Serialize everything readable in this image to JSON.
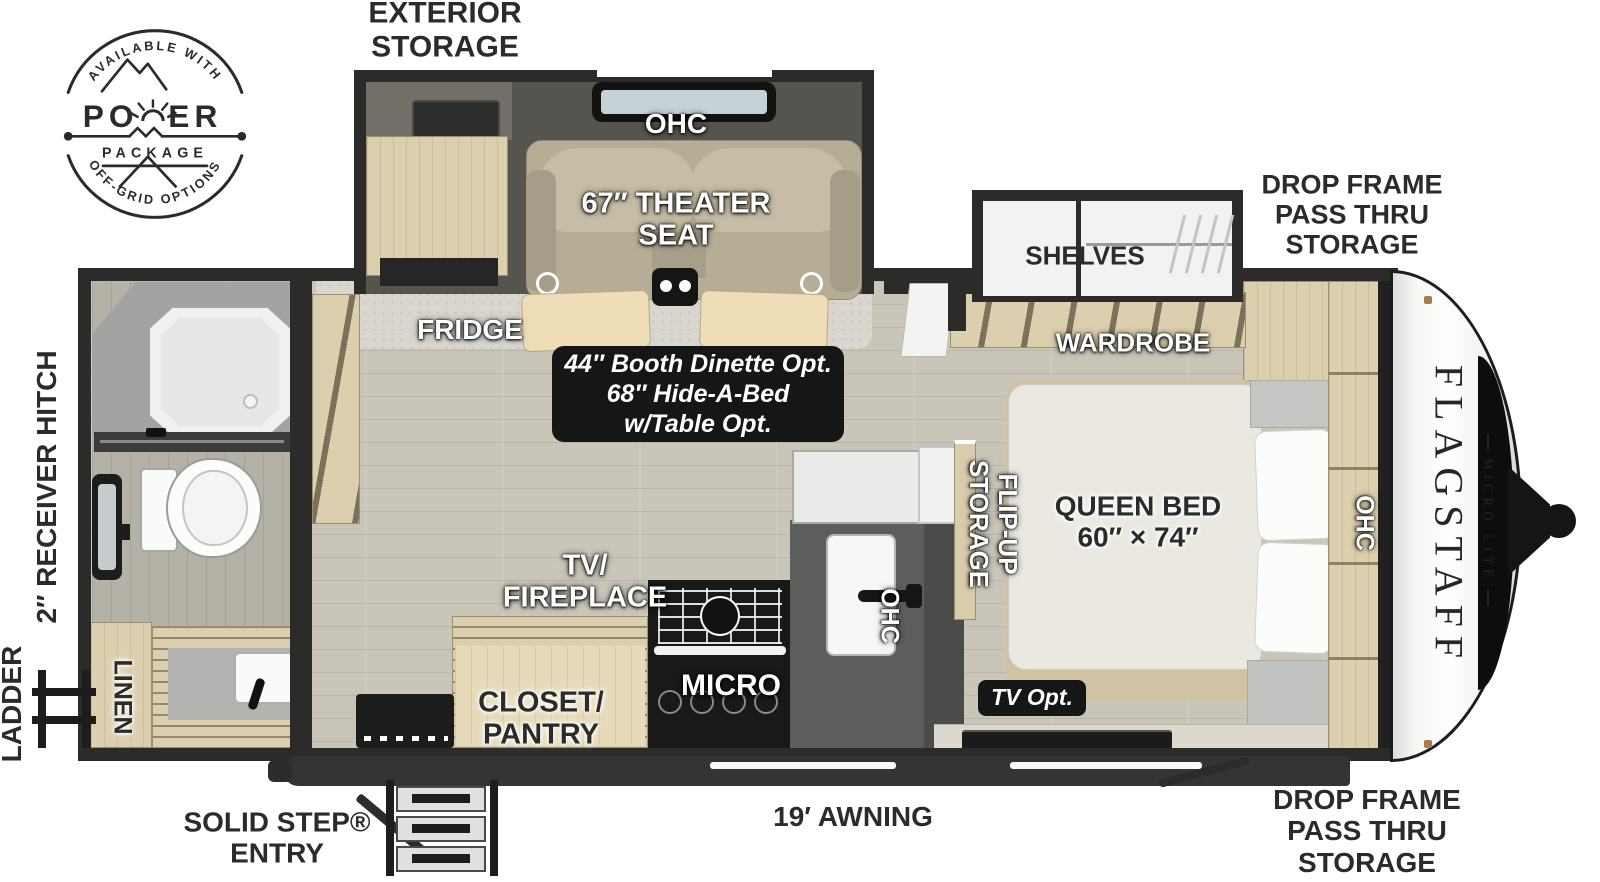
{
  "badge": {
    "arc_top": "AVAILABLE WITH",
    "power_left": "PO",
    "power_right": "ER",
    "package": "PACKAGE",
    "arc_bottom": "OFF-GRID OPTIONS"
  },
  "exterior": {
    "storage_top": [
      "EXTERIOR",
      "STORAGE"
    ],
    "drop_frame_front_top": [
      "DROP FRAME",
      "PASS THRU",
      "STORAGE"
    ],
    "drop_frame_front_bottom": [
      "DROP FRAME",
      "PASS THRU",
      "STORAGE"
    ],
    "receiver_hitch": "2″ RECEIVER HITCH",
    "ladder": "LADDER",
    "awning": "19′ AWNING",
    "solid_step": [
      "SOLID STEP®",
      "ENTRY"
    ]
  },
  "living_area": {
    "ohc": "OHC",
    "theater_seat": [
      "67″ THEATER",
      "SEAT"
    ],
    "fridge": "FRIDGE",
    "dinette_note": [
      "44″ Booth Dinette Opt.",
      "68″ Hide-A-Bed",
      "w/Table Opt."
    ],
    "tv_fireplace": [
      "TV/",
      "FIREPLACE"
    ],
    "closet_pantry": [
      "CLOSET/",
      "PANTRY"
    ],
    "micro": "MICRO",
    "ohc_kitchen": "OHC"
  },
  "bedroom": {
    "shelves": "SHELVES",
    "wardrobe": "WARDROBE",
    "queen_bed": [
      "QUEEN BED",
      "60″ × 74″"
    ],
    "flip_up": [
      "FLIP-UP",
      "STORAGE"
    ],
    "ohc": "OHC",
    "tv_opt": "TV Opt."
  },
  "bathroom": {
    "linen": "LINEN"
  },
  "brand": {
    "name": "FLAGSTAFF",
    "series": "MICRO LITE"
  },
  "colors": {
    "wall": "#2c2b29",
    "wood": "#dbcfae",
    "label_dark": "#2b2b2b",
    "floor": "#c9c5b9"
  }
}
